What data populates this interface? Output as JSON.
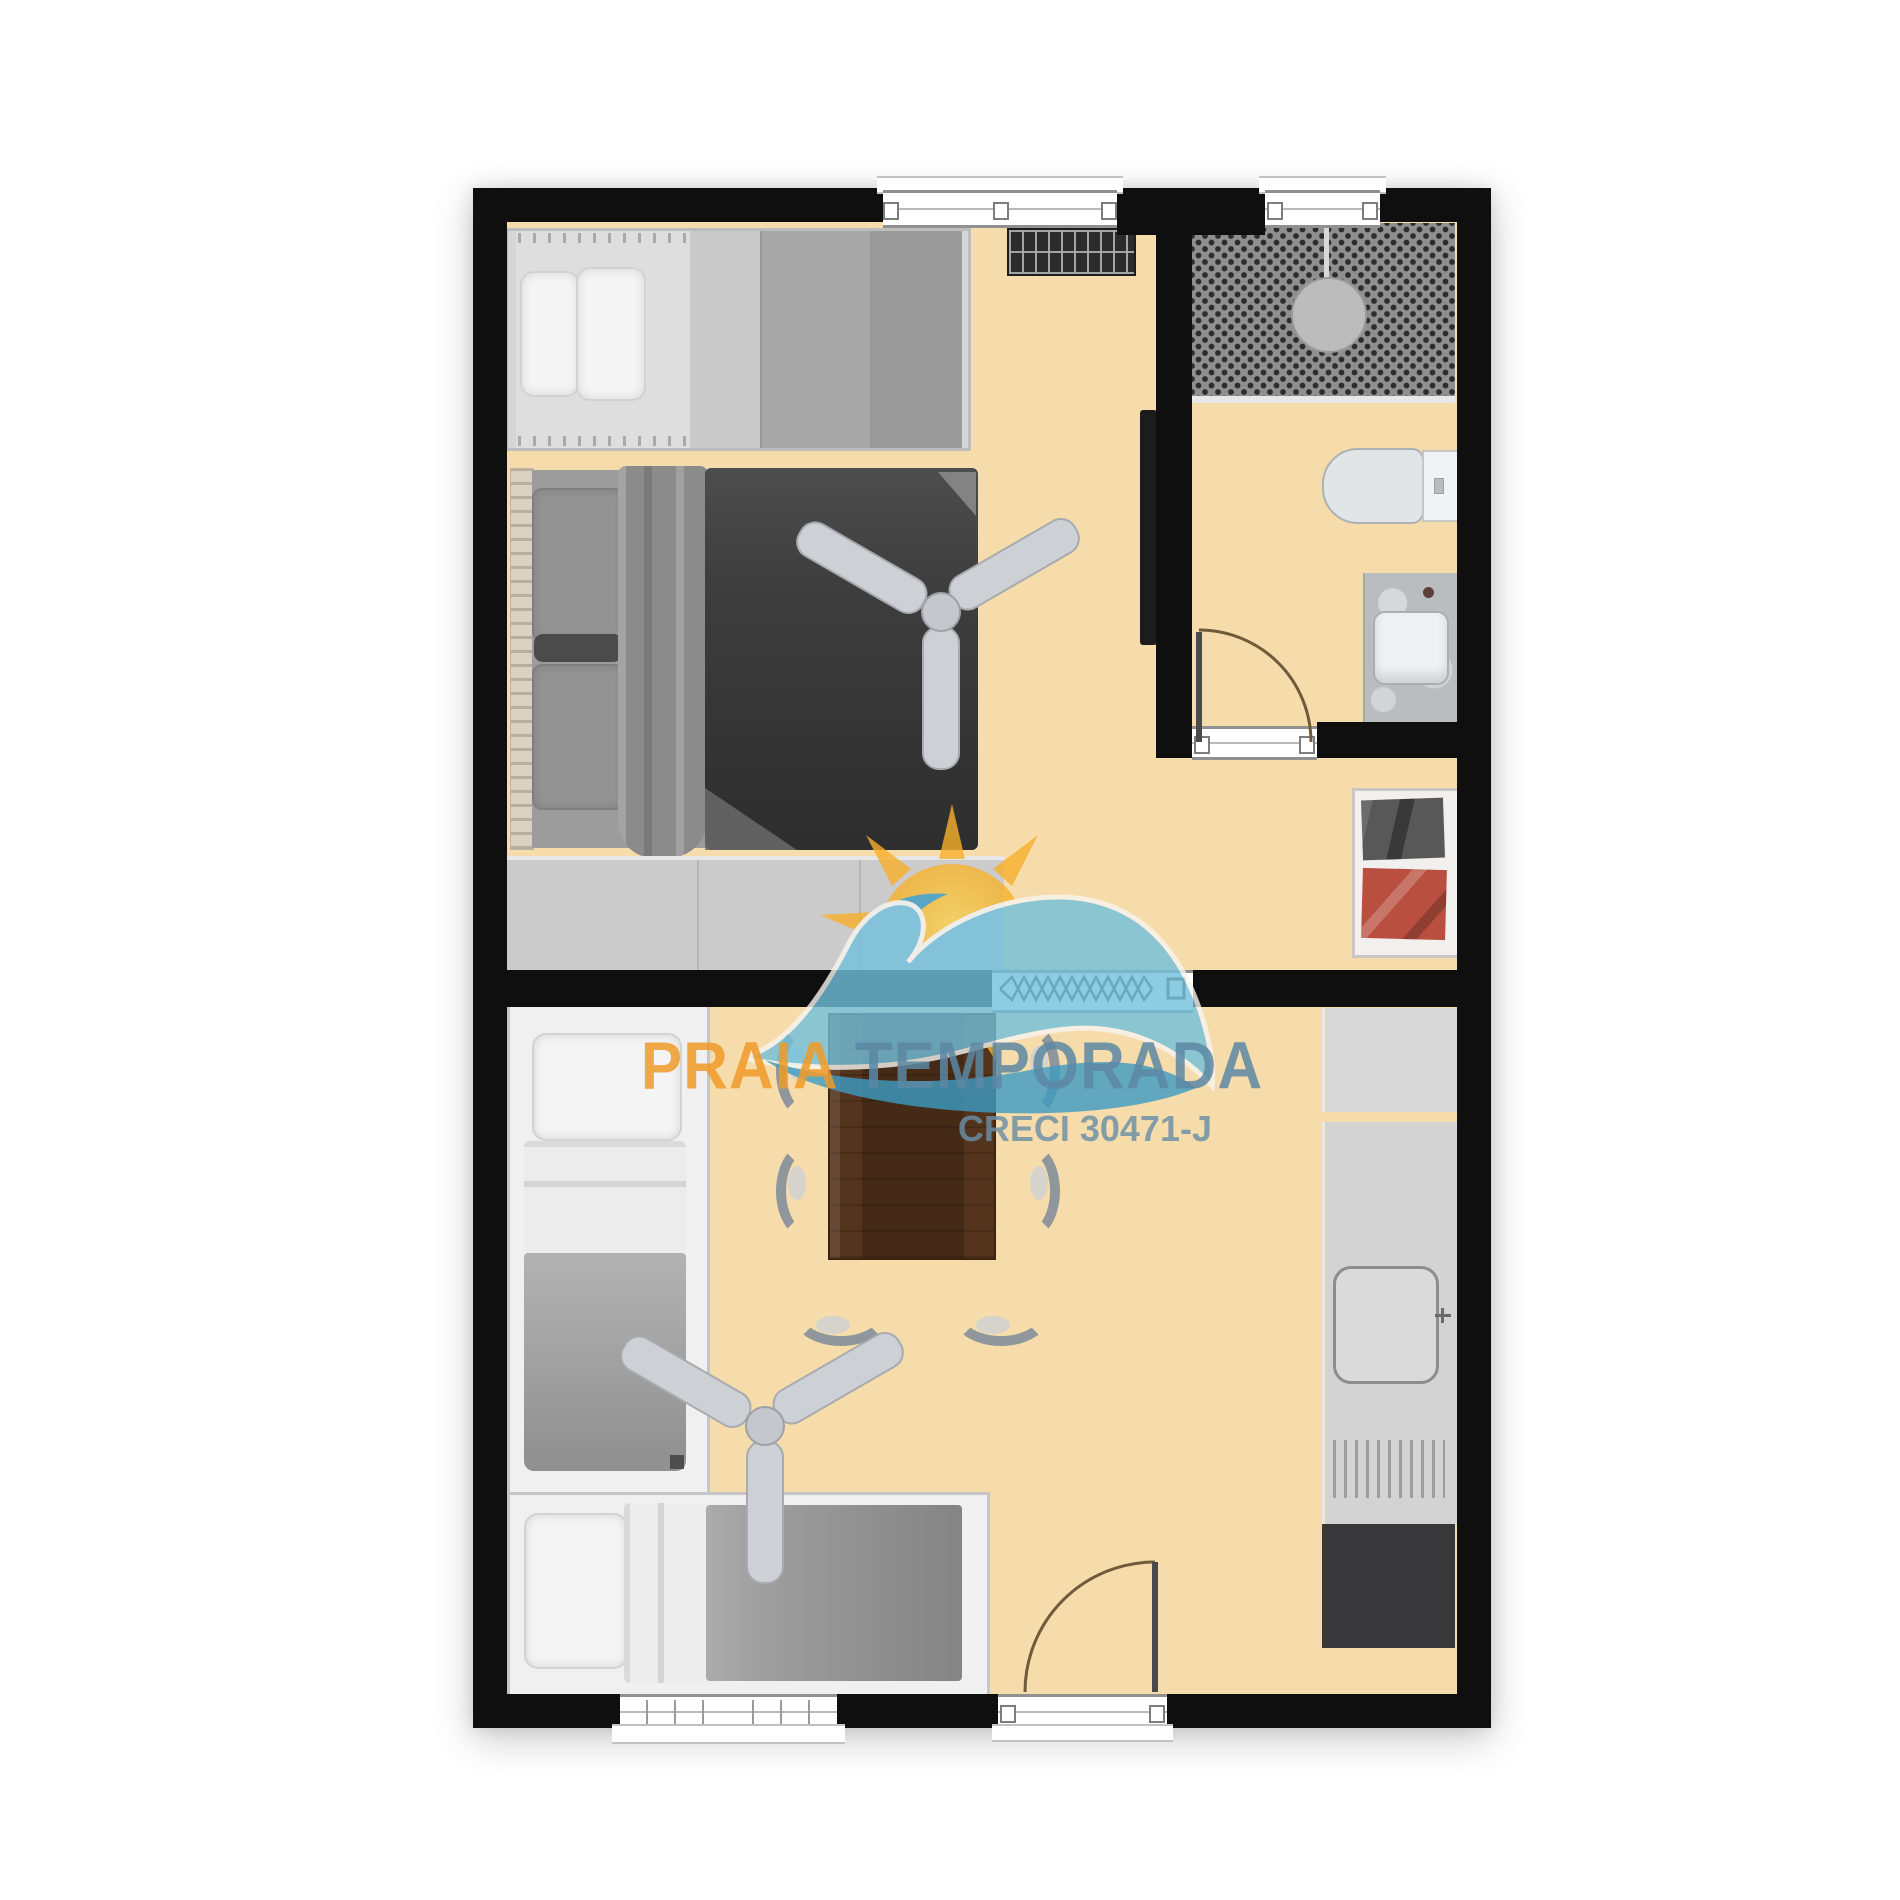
{
  "page": {
    "background": "#ffffff",
    "kind": "apartment floor plan render with agency watermark"
  },
  "watermark": {
    "brand_first": "PRAIA",
    "brand_second": "TEMPORADA",
    "license": "CRECI 30471-J",
    "colors": {
      "brand_first": "#ef9b28",
      "brand_second": "#5c88a4",
      "license": "#6a90a8",
      "sun_core": "#f6a623",
      "sun_light": "#fcd24e",
      "wave_light": "#72c0dc",
      "wave_deep": "#3d9cc3"
    }
  },
  "floorplan": {
    "wall_color": "#0f0f0f",
    "floor_color": "#f6dcaa",
    "accent_colors": {
      "dark_duvet": "#3e3e3e",
      "wood_table": "#55341d",
      "red_clothes": "#b9503f"
    },
    "rooms": [
      {
        "name": "bedroom-1",
        "furniture": [
          "single-bed",
          "double-bed",
          "ceiling-fan",
          "dresser",
          "radiator-grille",
          "wall-tv"
        ]
      },
      {
        "name": "bathroom",
        "furniture": [
          "shower-area",
          "shower-head",
          "toilet",
          "sink-vanity",
          "bathroom-door"
        ]
      },
      {
        "name": "hall-closet",
        "furniture": [
          "closet-shelf",
          "gray-clothes",
          "red-clothes"
        ]
      },
      {
        "name": "living-dining",
        "furniture": [
          "dining-table",
          "chair",
          "chair",
          "chair",
          "chair",
          "chair",
          "chair",
          "ceiling-fan",
          "entry-door"
        ]
      },
      {
        "name": "bedroom-2",
        "furniture": [
          "single-bed-vertical",
          "single-bed-horizontal"
        ]
      },
      {
        "name": "kitchen",
        "furniture": [
          "counter",
          "kitchen-sink",
          "drying-rack",
          "dark-appliance"
        ]
      }
    ],
    "openings": [
      "window-top-main",
      "window-top-bath",
      "window-bottom-bedroom2",
      "entry-door-opening",
      "bathroom-door-opening",
      "accordion-window"
    ]
  }
}
